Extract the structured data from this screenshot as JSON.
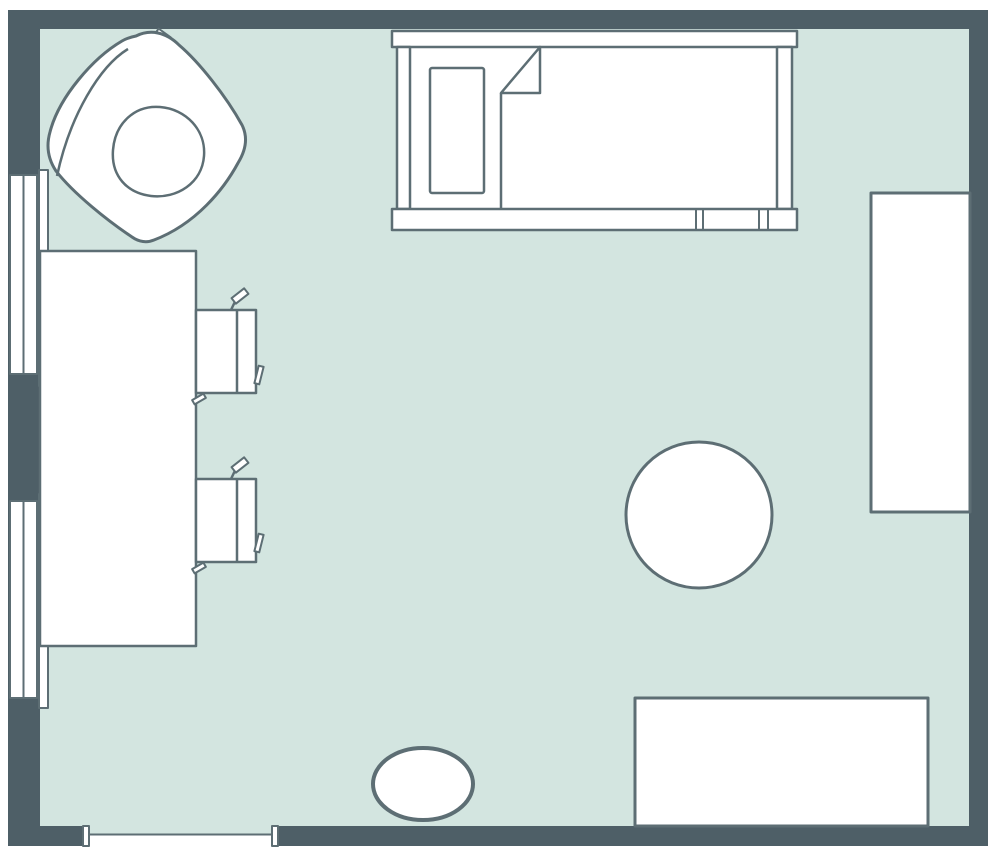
{
  "canvas": {
    "width": 1000,
    "height": 857,
    "background": "#ffffff"
  },
  "palette": {
    "wall": "#4e5f67",
    "floor": "#d3e5e0",
    "line": "#5d6e74",
    "white": "#ffffff"
  },
  "room": {
    "type": "bedroom-floorplan",
    "wall_thickness_top": 19,
    "wall_thickness_left": 32,
    "door_opening": {
      "x1": 83,
      "x2": 278,
      "side": "bottom"
    },
    "windows_on_left_wall": 2
  },
  "shapes": [
    {
      "name": "floor",
      "kind": "rect",
      "x": 40,
      "y": 29,
      "w": 929,
      "h": 797,
      "fill": "floor",
      "act": false
    },
    {
      "name": "wall-top",
      "kind": "rect",
      "x": 8,
      "y": 10,
      "w": 980,
      "h": 19,
      "fill": "wall",
      "act": true
    },
    {
      "name": "wall-left",
      "kind": "rect",
      "x": 8,
      "y": 10,
      "w": 32,
      "h": 836,
      "fill": "wall",
      "act": true
    },
    {
      "name": "wall-right",
      "kind": "rect",
      "x": 969,
      "y": 10,
      "w": 19,
      "h": 836,
      "fill": "wall",
      "act": true
    },
    {
      "name": "wall-bottom-left-segment",
      "kind": "rect",
      "x": 8,
      "y": 826,
      "w": 75,
      "h": 20,
      "fill": "wall",
      "act": true
    },
    {
      "name": "wall-bottom-right-segment",
      "kind": "rect",
      "x": 278,
      "y": 826,
      "w": 710,
      "h": 20,
      "fill": "wall",
      "act": true
    },
    {
      "name": "door-opening",
      "kind": "rect",
      "x": 83,
      "y": 826,
      "w": 195,
      "h": 20,
      "fill": "white",
      "act": true
    },
    {
      "name": "door-floor-strip",
      "kind": "rect",
      "x": 89,
      "y": 826,
      "w": 183,
      "h": 8,
      "fill": "floor",
      "act": false
    },
    {
      "name": "door-threshold-line",
      "kind": "line",
      "x1": 89,
      "y1": 834.5,
      "x2": 272,
      "y2": 834.5,
      "stroke": "line",
      "sw": 2,
      "act": false
    },
    {
      "name": "door-jamb-left",
      "kind": "rect",
      "x": 83,
      "y": 826,
      "w": 6,
      "h": 20,
      "fill": "white",
      "stroke": "line",
      "sw": 2,
      "act": true
    },
    {
      "name": "door-jamb-right",
      "kind": "rect",
      "x": 272,
      "y": 826,
      "w": 6,
      "h": 20,
      "fill": "white",
      "stroke": "line",
      "sw": 2,
      "act": true
    },
    {
      "name": "window-1-frame",
      "kind": "rect",
      "x": 10,
      "y": 175,
      "w": 27,
      "h": 199,
      "fill": "white",
      "stroke": "line",
      "sw": 2,
      "act": true
    },
    {
      "name": "window-1-divider",
      "kind": "line",
      "x1": 23.5,
      "y1": 175,
      "x2": 23.5,
      "y2": 374,
      "stroke": "line",
      "sw": 2,
      "act": false
    },
    {
      "name": "window-1-inner-sill",
      "kind": "rect",
      "x": 39,
      "y": 170,
      "w": 9,
      "h": 216,
      "fill": "white",
      "stroke": "line",
      "sw": 2,
      "act": true
    },
    {
      "name": "window-2-frame",
      "kind": "rect",
      "x": 10,
      "y": 501,
      "w": 27,
      "h": 197,
      "fill": "white",
      "stroke": "line",
      "sw": 2,
      "act": true
    },
    {
      "name": "window-2-divider",
      "kind": "line",
      "x1": 23.5,
      "y1": 501,
      "x2": 23.5,
      "y2": 698,
      "stroke": "line",
      "sw": 2,
      "act": false
    },
    {
      "name": "window-2-inner-sill",
      "kind": "rect",
      "x": 39,
      "y": 494,
      "w": 9,
      "h": 214,
      "fill": "white",
      "stroke": "line",
      "sw": 2,
      "act": true
    },
    {
      "name": "desk",
      "kind": "rect",
      "x": 40,
      "y": 251,
      "w": 156,
      "h": 395,
      "fill": "white",
      "stroke": "line",
      "sw": 2.5,
      "act": true
    },
    {
      "name": "chair-1-armrest-stem",
      "kind": "line",
      "x1": 230.5,
      "y1": 311,
      "x2": 236.5,
      "y2": 298.5,
      "stroke": "line",
      "sw": 2.5,
      "act": false
    },
    {
      "name": "chair-1-armrest-tab",
      "kind": "rect",
      "x": 232,
      "y": 292.5,
      "w": 16,
      "h": 7,
      "fill": "white",
      "stroke": "line",
      "sw": 2,
      "transform": "rotate(-38 240 296)",
      "act": false
    },
    {
      "name": "chair-1-seat",
      "kind": "rect",
      "x": 196,
      "y": 310,
      "w": 60,
      "h": 83,
      "fill": "white",
      "stroke": "line",
      "sw": 2.5,
      "act": true
    },
    {
      "name": "chair-1-backrest-divider",
      "kind": "line",
      "x1": 237,
      "y1": 310,
      "x2": 237,
      "y2": 393,
      "stroke": "line",
      "sw": 2.5,
      "act": false
    },
    {
      "name": "chair-1-corner-hook",
      "kind": "rect",
      "x": 192.5,
      "y": 396.5,
      "w": 13,
      "h": 5,
      "fill": "white",
      "stroke": "line",
      "sw": 2,
      "transform": "rotate(-30 199 399)",
      "act": false
    },
    {
      "name": "chair-1-side-flap",
      "kind": "rect",
      "x": 256.5,
      "y": 366,
      "w": 5,
      "h": 18,
      "fill": "white",
      "stroke": "line",
      "sw": 2,
      "transform": "rotate(14 259 375)",
      "act": false
    },
    {
      "name": "chair-2-armrest-stem",
      "kind": "line",
      "x1": 230.5,
      "y1": 480,
      "x2": 236.5,
      "y2": 467.5,
      "stroke": "line",
      "sw": 2.5,
      "act": false
    },
    {
      "name": "chair-2-armrest-tab",
      "kind": "rect",
      "x": 232,
      "y": 461.5,
      "w": 16,
      "h": 7,
      "fill": "white",
      "stroke": "line",
      "sw": 2,
      "transform": "rotate(-38 240 465)",
      "act": false
    },
    {
      "name": "chair-2-seat",
      "kind": "rect",
      "x": 196,
      "y": 479,
      "w": 60,
      "h": 83,
      "fill": "white",
      "stroke": "line",
      "sw": 2.5,
      "act": true
    },
    {
      "name": "chair-2-backrest-divider",
      "kind": "line",
      "x1": 237,
      "y1": 479,
      "x2": 237,
      "y2": 562,
      "stroke": "line",
      "sw": 2.5,
      "act": false
    },
    {
      "name": "chair-2-corner-hook",
      "kind": "rect",
      "x": 192.5,
      "y": 565.5,
      "w": 13,
      "h": 5,
      "fill": "white",
      "stroke": "line",
      "sw": 2,
      "transform": "rotate(-30 199 568)",
      "act": false
    },
    {
      "name": "chair-2-side-flap",
      "kind": "rect",
      "x": 256.5,
      "y": 534,
      "w": 5,
      "h": 18,
      "fill": "white",
      "stroke": "line",
      "sw": 2,
      "transform": "rotate(14 259 543)",
      "act": false
    },
    {
      "name": "armchair-headrest-tab",
      "kind": "rect",
      "x": 154,
      "y": 32,
      "w": 15,
      "h": 11,
      "fill": "white",
      "stroke": "line",
      "sw": 2,
      "transform": "rotate(36 161.5 37.5)",
      "act": false
    },
    {
      "name": "armchair-body",
      "kind": "path",
      "d": "M136,36 C150,29 166,32 179,45 C199,62 226,96 242,125 C248,137 246,150 238,163 C224,189 196,224 154,240 C147,243 139,242 132,237 C108,221 74,194 56,171 C48,159 46,146 50,132 C59,97 93,58 122,41 C127,38 131,37 136,36 Z",
      "fill": "white",
      "stroke": "line",
      "sw": 3,
      "act": true
    },
    {
      "name": "armchair-backrest-crease",
      "kind": "path",
      "d": "M128,49 C100,66 70,115 57,176",
      "fill": "none",
      "stroke": "line",
      "sw": 2.5,
      "act": false
    },
    {
      "name": "armchair-seat-cushion",
      "kind": "path",
      "d": "M160,107 C186,109 206,130 204,156 C202,183 177,199 151,196 C127,193 111,176 113,150 C115,124 134,105 160,107 Z",
      "fill": "white",
      "stroke": "line",
      "sw": 2.5,
      "act": false
    },
    {
      "name": "bed-mattress",
      "kind": "rect",
      "x": 410,
      "y": 47,
      "w": 367,
      "h": 162,
      "fill": "white",
      "act": true
    },
    {
      "name": "bed-headboard-rail",
      "kind": "rect",
      "x": 392,
      "y": 31,
      "w": 405,
      "h": 16,
      "fill": "white",
      "stroke": "line",
      "sw": 2.5,
      "act": true
    },
    {
      "name": "bed-side-post-left",
      "kind": "rect",
      "x": 397,
      "y": 47,
      "w": 13,
      "h": 162,
      "fill": "white",
      "stroke": "line",
      "sw": 2.5,
      "act": false
    },
    {
      "name": "bed-side-post-right",
      "kind": "rect",
      "x": 777,
      "y": 47,
      "w": 15,
      "h": 162,
      "fill": "white",
      "stroke": "line",
      "sw": 2.5,
      "act": false
    },
    {
      "name": "bed-footboard-rail",
      "kind": "rect",
      "x": 392,
      "y": 209,
      "w": 405,
      "h": 21,
      "fill": "white",
      "stroke": "line",
      "sw": 2.5,
      "act": true
    },
    {
      "name": "bed-footboard-divider-1",
      "kind": "line",
      "x1": 696,
      "y1": 209,
      "x2": 696,
      "y2": 230,
      "stroke": "line",
      "sw": 2,
      "act": false
    },
    {
      "name": "bed-footboard-divider-2",
      "kind": "line",
      "x1": 703,
      "y1": 209,
      "x2": 703,
      "y2": 230,
      "stroke": "line",
      "sw": 2,
      "act": false
    },
    {
      "name": "bed-footboard-divider-3",
      "kind": "line",
      "x1": 759,
      "y1": 209,
      "x2": 759,
      "y2": 230,
      "stroke": "line",
      "sw": 2,
      "act": false
    },
    {
      "name": "bed-footboard-divider-4",
      "kind": "line",
      "x1": 768,
      "y1": 209,
      "x2": 768,
      "y2": 230,
      "stroke": "line",
      "sw": 2,
      "act": false
    },
    {
      "name": "bed-pillow",
      "kind": "rect",
      "x": 430,
      "y": 68,
      "w": 54,
      "h": 125,
      "rx": 2,
      "fill": "white",
      "stroke": "line",
      "sw": 2.5,
      "act": false
    },
    {
      "name": "bed-blanket-fold",
      "kind": "path",
      "d": "M501,93 L540,47 L540,93 Z",
      "fill": "white",
      "stroke": "line",
      "sw": 2.5,
      "act": false
    },
    {
      "name": "bed-blanket-edge",
      "kind": "line",
      "x1": 501,
      "y1": 93,
      "x2": 501,
      "y2": 209,
      "stroke": "line",
      "sw": 2.5,
      "act": false
    },
    {
      "name": "wardrobe",
      "kind": "rect",
      "x": 871,
      "y": 193,
      "w": 99,
      "h": 319,
      "fill": "white",
      "stroke": "line",
      "sw": 3,
      "act": true
    },
    {
      "name": "round-table",
      "kind": "circle",
      "cx": 699,
      "cy": 515,
      "r": 73,
      "fill": "white",
      "stroke": "line",
      "sw": 3,
      "act": true
    },
    {
      "name": "dresser",
      "kind": "rect",
      "x": 635,
      "y": 698,
      "w": 293,
      "h": 128,
      "fill": "white",
      "stroke": "line",
      "sw": 3,
      "act": true
    },
    {
      "name": "oval-rug",
      "kind": "ellipse",
      "cx": 423,
      "cy": 784,
      "rx": 50,
      "ry": 36,
      "fill": "white",
      "stroke": "line",
      "sw": 4,
      "act": true
    }
  ]
}
